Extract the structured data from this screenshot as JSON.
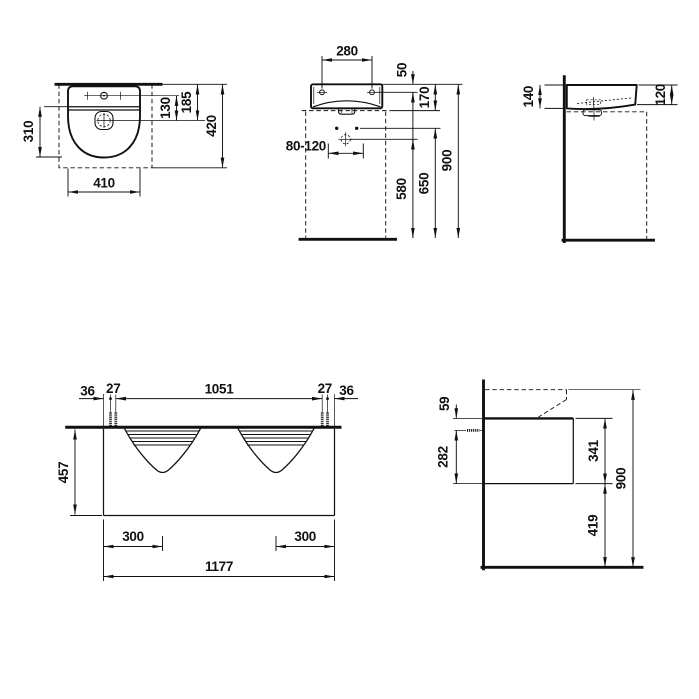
{
  "drawing": {
    "background": "#ffffff",
    "line_color": "#111111",
    "views": {
      "washbasin_top": {
        "title": "washbasin plan view",
        "dims": {
          "depth": "310",
          "width": "410",
          "tap_to_drain": "130",
          "rear_to_drain": "185",
          "total_depth": "420"
        }
      },
      "washbasin_front": {
        "title": "washbasin front elevation",
        "dims": {
          "hole_spacing": "280",
          "rim_to_holes": "50",
          "basin_height": "170",
          "supply_range": "80-120",
          "drain_height": "580",
          "fixing_height": "650",
          "rim_height": "900"
        }
      },
      "washbasin_side": {
        "title": "washbasin side elevation",
        "dims": {
          "depth_at_wall": "140",
          "depth_at_front": "120"
        }
      },
      "vanity_front": {
        "title": "vanity front elevation",
        "dims": {
          "edge_to_screw_left": "36",
          "screw_pair_left": "27",
          "screw_span": "1051",
          "screw_pair_right": "27",
          "edge_to_screw_right": "36",
          "cabinet_height": "457",
          "drain_offset_left": "300",
          "drain_offset_right": "300",
          "cabinet_width": "1177"
        }
      },
      "vanity_side": {
        "title": "vanity side elevation",
        "dims": {
          "top_to_screw": "59",
          "screw_to_bottom": "282",
          "body_height": "341",
          "bottom_clearance": "419",
          "total_height": "900"
        }
      }
    }
  }
}
